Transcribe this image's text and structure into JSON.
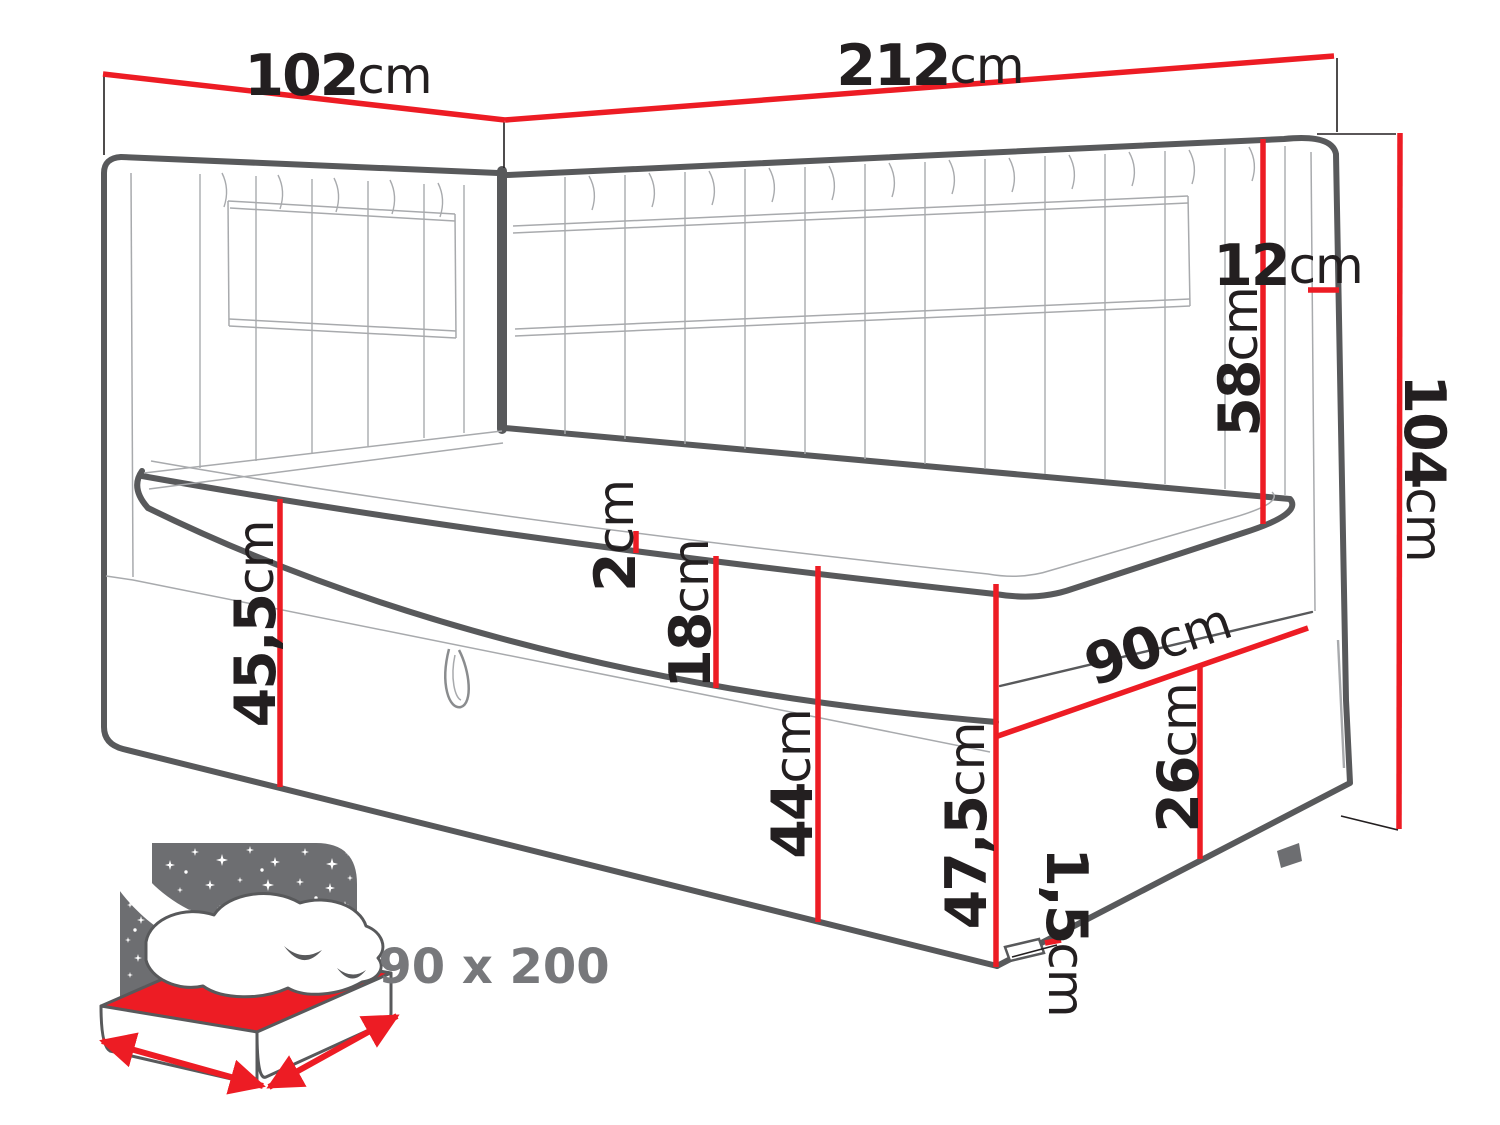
{
  "diagram": {
    "type": "furniture-dimension-drawing",
    "subject": "corner daybed with two tufted headboards and storage drawer",
    "dimensions": {
      "side_width": {
        "value": "102",
        "unit": "cm"
      },
      "front_width": {
        "value": "212",
        "unit": "cm"
      },
      "headboard_thickness": {
        "value": "12",
        "unit": "cm"
      },
      "headboard_above_mattress": {
        "value": "58",
        "unit": "cm"
      },
      "total_height": {
        "value": "104",
        "unit": "cm"
      },
      "topper_height": {
        "value": "2",
        "unit": "cm"
      },
      "mattress_height": {
        "value": "18",
        "unit": "cm"
      },
      "base_height_left": {
        "value": "45,5",
        "unit": "cm"
      },
      "front_panel_height": {
        "value": "44",
        "unit": "cm"
      },
      "side_depth": {
        "value": "90",
        "unit": "cm"
      },
      "corner_height": {
        "value": "47,5",
        "unit": "cm"
      },
      "side_panel_height": {
        "value": "26",
        "unit": "cm"
      },
      "foot_height": {
        "value": "1,5",
        "unit": "cm"
      }
    },
    "sleeping_area": {
      "label": "90 x 200"
    },
    "colors": {
      "dimension_red": "#ed1c24",
      "outline_gray": "#58595b",
      "detail_gray": "#a8aaad",
      "icon_gray": "#6d6e71",
      "label_gray": "#77787b",
      "text_black": "#231f20"
    }
  }
}
